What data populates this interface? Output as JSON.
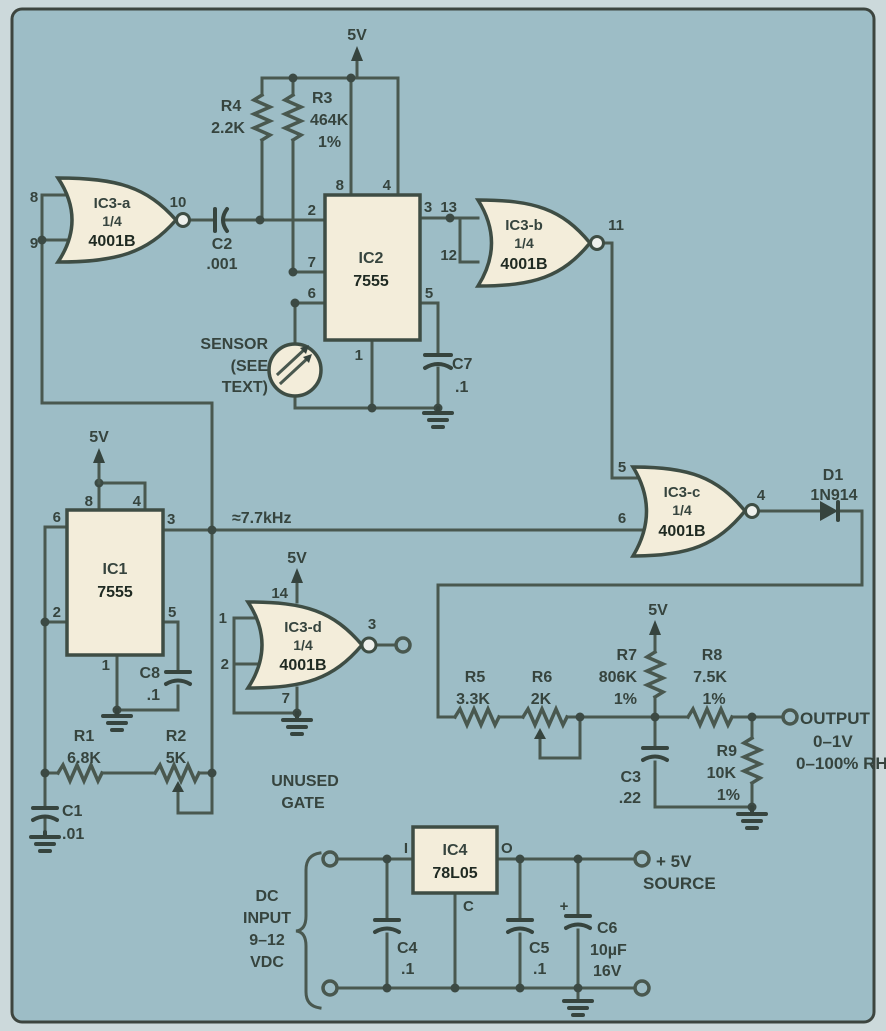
{
  "power": {
    "v5": "5V",
    "plus5": "+ 5V",
    "source": "SOURCE",
    "freq": "≈7.7kHz"
  },
  "ic1": {
    "name": "IC1",
    "part": "7555",
    "p8": "8",
    "p4": "4",
    "p6": "6",
    "p2": "2",
    "p3": "3",
    "p5": "5",
    "p1": "1"
  },
  "ic2": {
    "name": "IC2",
    "part": "7555",
    "p2": "2",
    "p7": "7",
    "p6": "6",
    "p8": "8",
    "p4": "4",
    "p3": "3",
    "p5": "5",
    "p1": "1"
  },
  "ic3a": {
    "name": "IC3-a",
    "frac": "1/4",
    "part": "4001B",
    "in1": "8",
    "in2": "9",
    "out": "10"
  },
  "ic3b": {
    "name": "IC3-b",
    "frac": "1/4",
    "part": "4001B",
    "in1": "13",
    "in2": "12",
    "out": "11"
  },
  "ic3c": {
    "name": "IC3-c",
    "frac": "1/4",
    "part": "4001B",
    "in1": "5",
    "in2": "6",
    "out": "4"
  },
  "ic3d": {
    "name": "IC3-d",
    "frac": "1/4",
    "part": "4001B",
    "in1": "1",
    "in2": "2",
    "out": "3",
    "vdd": "14",
    "gnd": "7",
    "note1": "UNUSED",
    "note2": "GATE"
  },
  "ic4": {
    "name": "IC4",
    "part": "78L05",
    "pin_in": "I",
    "pin_out": "O",
    "pin_common": "C"
  },
  "r1": {
    "ref": "R1",
    "value": "6.8K"
  },
  "r2": {
    "ref": "R2",
    "value": "5K"
  },
  "r3": {
    "ref": "R3",
    "value": "464K",
    "tol": "1%"
  },
  "r4": {
    "ref": "R4",
    "value": "2.2K"
  },
  "r5": {
    "ref": "R5",
    "value": "3.3K"
  },
  "r6": {
    "ref": "R6",
    "value": "2K"
  },
  "r7": {
    "ref": "R7",
    "value": "806K",
    "tol": "1%"
  },
  "r8": {
    "ref": "R8",
    "value": "7.5K",
    "tol": "1%"
  },
  "r9": {
    "ref": "R9",
    "value": "10K",
    "tol": "1%"
  },
  "c1": {
    "ref": "C1",
    "value": ".01"
  },
  "c2": {
    "ref": "C2",
    "value": ".001"
  },
  "c3": {
    "ref": "C3",
    "value": ".22"
  },
  "c4": {
    "ref": "C4",
    "value": ".1"
  },
  "c5": {
    "ref": "C5",
    "value": ".1"
  },
  "c6": {
    "ref": "C6",
    "value": "10µF",
    "rating": "16V",
    "plus": "+"
  },
  "c7": {
    "ref": "C7",
    "value": ".1"
  },
  "c8": {
    "ref": "C8",
    "value": ".1"
  },
  "d1": {
    "ref": "D1",
    "part": "1N914"
  },
  "sensor": {
    "l1": "SENSOR",
    "l2": "(SEE",
    "l3": "TEXT)"
  },
  "output": {
    "l1": "OUTPUT",
    "l2": "0–1V",
    "l3": "0–100% RH"
  },
  "dc_input": {
    "l1": "DC",
    "l2": "INPUT",
    "l3": "9–12",
    "l4": "VDC"
  },
  "colors": {
    "paper": "#9dbdc6",
    "margin": "#ccd9db",
    "wire": "#49584f",
    "component_fill": "#f3edda",
    "text": "#36443e"
  }
}
